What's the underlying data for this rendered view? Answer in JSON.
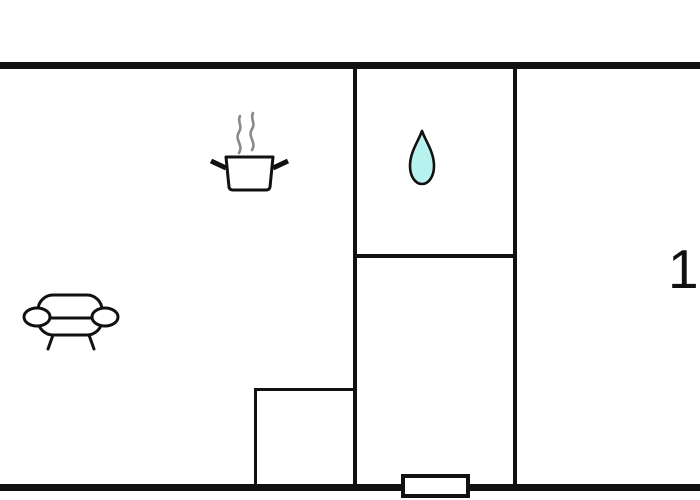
{
  "floorplan": {
    "room_label": "1",
    "colors": {
      "background": "#ffffff",
      "wall": "#111111",
      "drop_fill": "#b8f2ee",
      "steam": "#8a8a8a"
    },
    "icons": [
      {
        "name": "cooking-pot-icon"
      },
      {
        "name": "steam-icon"
      },
      {
        "name": "water-drop-icon"
      },
      {
        "name": "sofa-icon"
      }
    ]
  }
}
